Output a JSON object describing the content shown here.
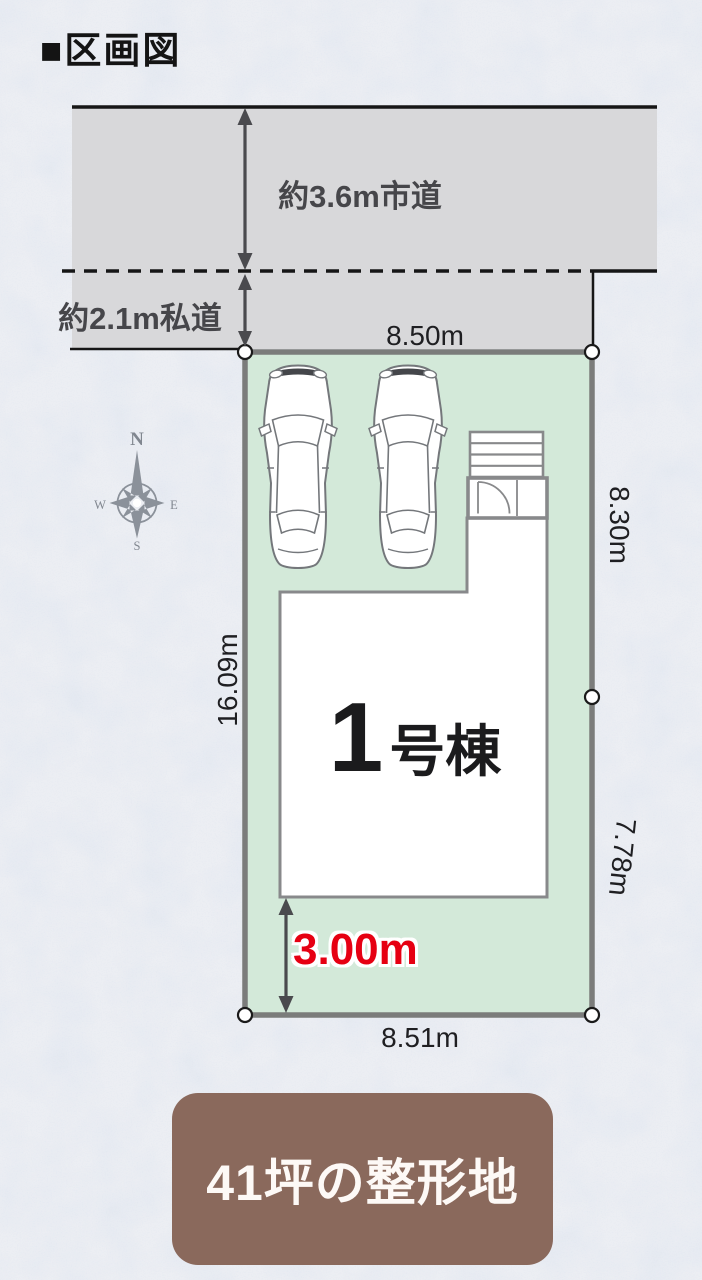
{
  "title": "■区画図",
  "roads": {
    "city": "約3.6m市道",
    "private": "約2.1m私道"
  },
  "dimensions": {
    "top": "8.50m",
    "bottom": "8.51m",
    "right_upper": "8.30m",
    "right_lower": "7.78m",
    "left": "16.09m",
    "setback": "3.00m"
  },
  "building": {
    "number": "1",
    "suffix": "号棟"
  },
  "compass": {
    "n": "N",
    "e": "E",
    "s": "S",
    "w": "W"
  },
  "banner": "41坪の整形地",
  "colors": {
    "plot_green": "#d3e9d9",
    "road_gray": "#d8d8da",
    "accent_red": "#e60012",
    "banner_brown": "#8a695c",
    "plot_border_gray": "#7b7c7b",
    "building_stroke_gray": "#88898b"
  }
}
